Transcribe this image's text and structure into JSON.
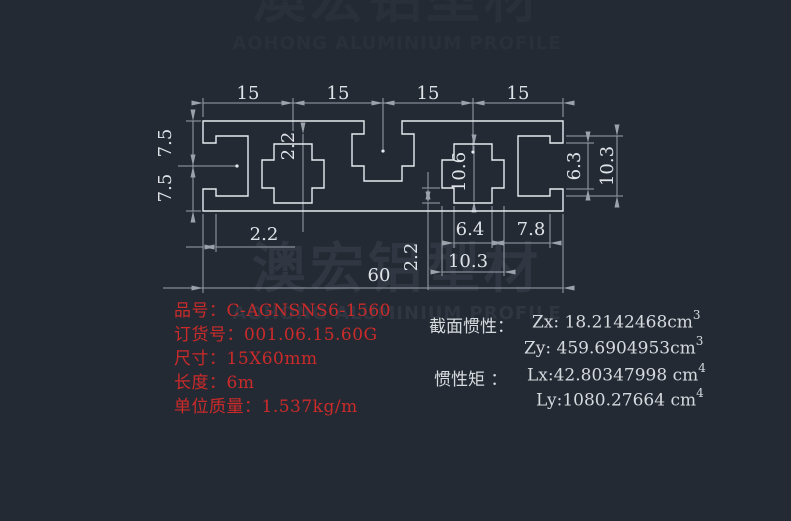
{
  "canvas": {
    "background": "#242a33"
  },
  "watermark": {
    "cn": "澳宏铝型材",
    "en": "AOHONG ALUMINIUM PROFILE"
  },
  "dims": {
    "top": [
      "15",
      "15",
      "15",
      "15"
    ],
    "left": [
      "7.5",
      "7.5"
    ],
    "right_opening": "6.3",
    "right_cavity": "10.3",
    "wall_top": "2.2",
    "cavity_height": "10.6",
    "wall_step": "2.2",
    "lip_thickness": "2.2",
    "slot_narrow_width": "6.4",
    "web_gap": "7.8",
    "slot_wide_width": "10.3",
    "overall_width": "60"
  },
  "product": {
    "rows": [
      {
        "label": "品号：",
        "value": "C-AGNSNS6-1560"
      },
      {
        "label": "订货号：",
        "value": "001.06.15.60G"
      },
      {
        "label": "尺寸：",
        "value": "15X60mm"
      },
      {
        "label": "长度：",
        "value": "6m"
      },
      {
        "label": "单位质量：",
        "value": "1.537kg/m"
      }
    ]
  },
  "section": {
    "inertia_label": "截面惯性：",
    "zx": "Zx: 18.2142468cm",
    "zx_exp": "3",
    "zy": "Zy: 459.6904953cm",
    "zy_exp": "3",
    "moment_label": "惯性矩 ：",
    "lx": "Lx:42.80347998 cm",
    "lx_exp": "4",
    "ly": "Ly:1080.27664 cm",
    "ly_exp": "4"
  }
}
